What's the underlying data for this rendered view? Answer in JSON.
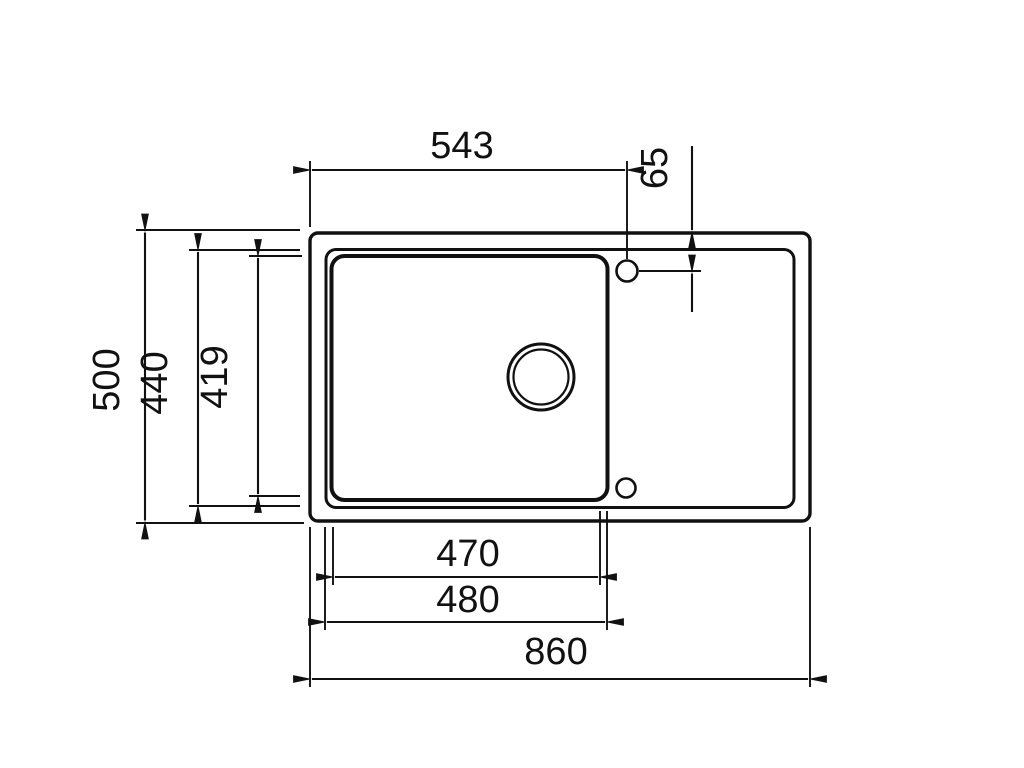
{
  "drawing": {
    "type": "sink-top-view-dimension-drawing",
    "colors": {
      "ink": "#111111",
      "background": "#ffffff"
    },
    "dimensions": {
      "tap_hole_offset_x": "543",
      "tap_hole_offset_y": "65",
      "overall_depth": "500",
      "rim_depth": "440",
      "bowl_depth": "419",
      "bowl_width_inner": "470",
      "bowl_width_outer": "480",
      "overall_length": "860"
    },
    "parts": {
      "outline": "sink-outer-edge",
      "rim": "sink-rim",
      "bowl": "sink-bowl",
      "drain": "drain-hole",
      "tap_hole_top": "tap-hole-top",
      "tap_hole_bottom": "tap-hole-bottom"
    }
  }
}
